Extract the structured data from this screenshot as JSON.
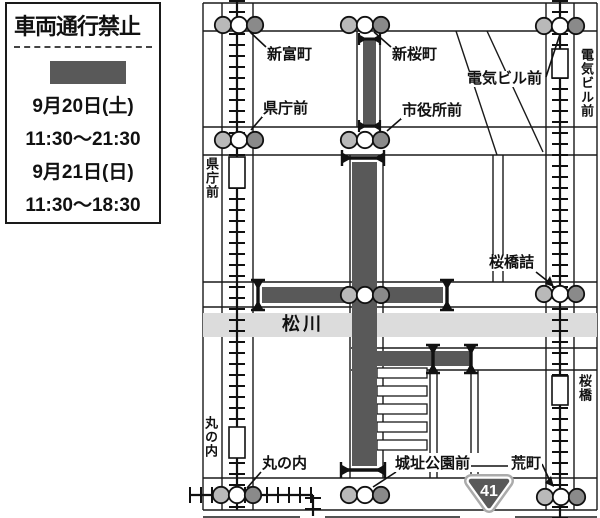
{
  "legend": {
    "title": "車両通行禁止",
    "schedule": [
      {
        "date": "9月20日(土)",
        "time": "11:30〜21:30"
      },
      {
        "date": "9月21日(日)",
        "time": "11:30〜18:30"
      }
    ]
  },
  "map": {
    "river_label": "松川",
    "route_number": "41",
    "stops": [
      {
        "label": "新富町"
      },
      {
        "label": "新桜町"
      },
      {
        "label": "電気ビル前"
      },
      {
        "label": "県庁前"
      },
      {
        "label": "市役所前"
      },
      {
        "label": "桜橋詰"
      },
      {
        "label": "丸の内"
      },
      {
        "label": "城址公園前"
      },
      {
        "label": "荒町"
      }
    ],
    "vertical_labels": [
      {
        "label": "県庁前"
      },
      {
        "label": "電気ビル前"
      },
      {
        "label": "丸の内"
      },
      {
        "label": "桜橋"
      }
    ],
    "colors": {
      "closed_road": "#595959",
      "river": "#dcdcdc",
      "stop_light": "#b9b9b9",
      "stop_dark": "#8a8a8a",
      "line": "#1a1a1a"
    }
  }
}
